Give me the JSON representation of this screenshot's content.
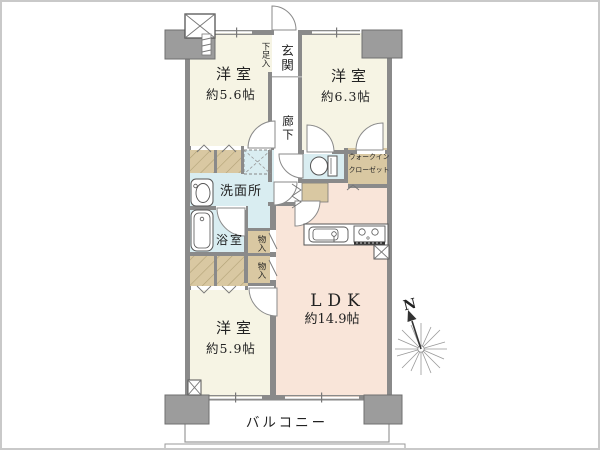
{
  "colors": {
    "wall": "#8a8a8a",
    "column": "#9c9c9c",
    "colb": "#6f6f6f",
    "cream": "#f6f4e4",
    "pink": "#f9e5d9",
    "blue": "#d9edf1",
    "tan": "#d9c8a2",
    "line": "#555555",
    "text": "#222222"
  },
  "rooms": {
    "bedroom_top_left": {
      "name": "洋室",
      "size": "約5.6帖"
    },
    "bedroom_top_right": {
      "name": "洋室",
      "size": "約6.3帖"
    },
    "bedroom_bottom": {
      "name": "洋室",
      "size": "約5.9帖"
    },
    "ldk": {
      "name": "LDK",
      "size": "約14.9帖"
    },
    "entrance": "玄関",
    "shoe_cabinet": "下足入",
    "hallway": "廊下",
    "washroom": "洗面所",
    "bathroom": "浴室",
    "storage_upper": "物入",
    "storage_lower": "物入",
    "walk_in_closet_line1": "ウォークイン",
    "walk_in_closet_line2": "クローゼット",
    "balcony": "バルコニー"
  },
  "compass": {
    "north_label": "N"
  }
}
